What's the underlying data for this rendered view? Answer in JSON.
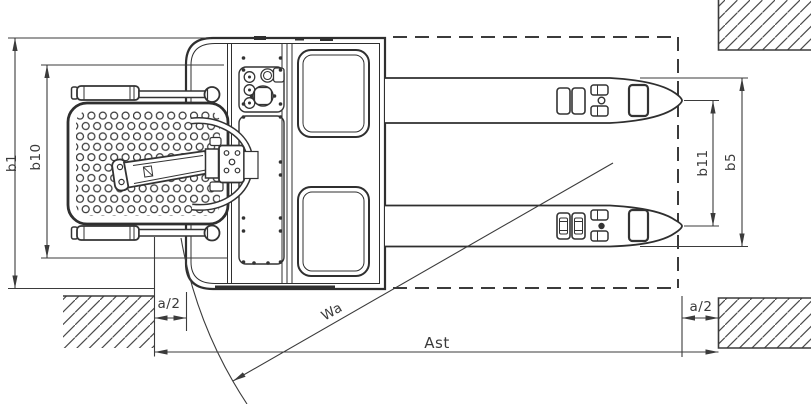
{
  "figure": {
    "type": "technical-line-drawing",
    "view": "top-view pallet truck turning in aisle between hatched obstacles"
  },
  "labels": {
    "b1": "b1",
    "b10": "b10",
    "b11": "b11",
    "b5": "b5",
    "a2_left": "a/2",
    "a2_right": "a/2",
    "wa": "Wa",
    "ast": "Ast"
  },
  "colors": {
    "background": "#ffffff",
    "line": "#3b3b3b",
    "outline": "#2f2f2f",
    "hatch": "#4a4a4a"
  }
}
